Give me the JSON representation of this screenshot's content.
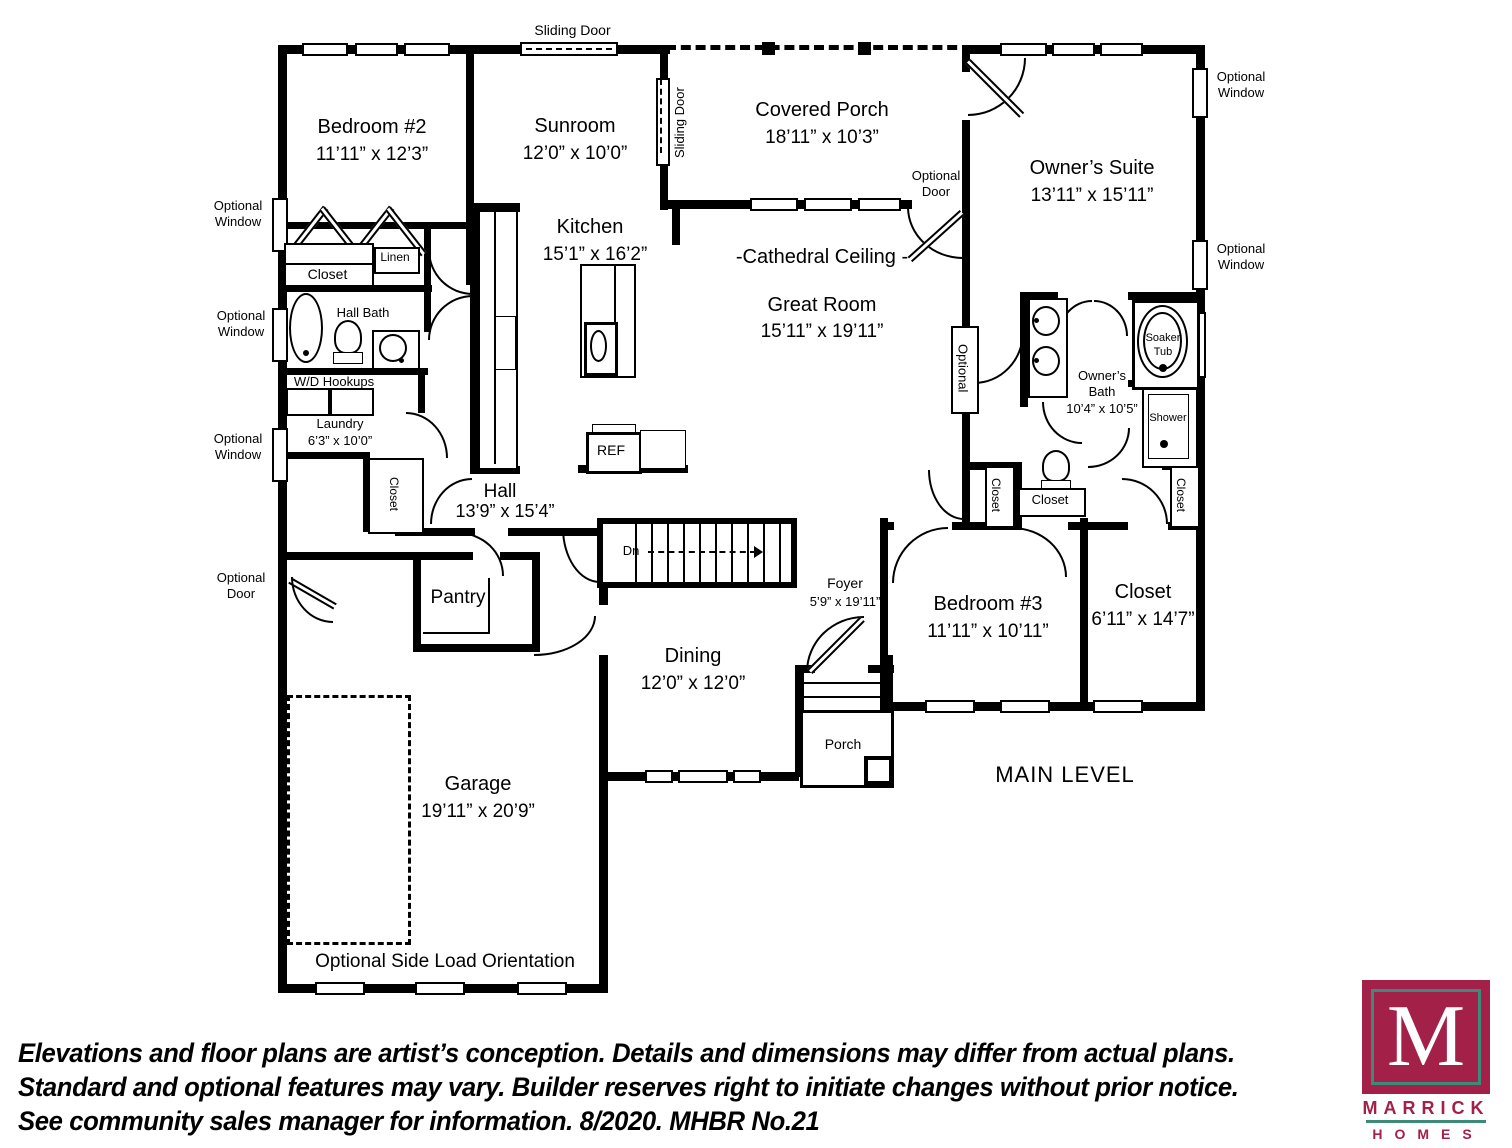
{
  "plan": {
    "level_title": "MAIN LEVEL",
    "rooms": {
      "bedroom2": {
        "name": "Bedroom #2",
        "dims": "11’11” x 12’3”"
      },
      "sunroom": {
        "name": "Sunroom",
        "dims": "12’0” x 10’0”"
      },
      "covered_porch": {
        "name": "Covered Porch",
        "dims": "18’11” x 10’3”"
      },
      "owners_suite": {
        "name": "Owner’s Suite",
        "dims": "13’11” x 15’11”"
      },
      "kitchen": {
        "name": "Kitchen",
        "dims": "15’1” x 16’2”"
      },
      "great_room": {
        "name": "Great Room",
        "dims": "15’11” x 19’11”",
        "note": "-Cathedral Ceiling -"
      },
      "laundry": {
        "name": "Laundry",
        "dims": "6’3” x 10’0”"
      },
      "hall": {
        "name": "Hall",
        "dims": "13’9” x 15’4”"
      },
      "owners_bath": {
        "name": "Owner’s\nBath\n10’4” x 10’5”"
      },
      "foyer": {
        "name": "Foyer",
        "dims": "5’9” x 19’11”"
      },
      "dining": {
        "name": "Dining",
        "dims": "12’0” x 12’0”"
      },
      "bedroom3": {
        "name": "Bedroom #3",
        "dims": "11’11” x 10’11”"
      },
      "closet_big": {
        "name": "Closet",
        "dims": "6’11” x 14’7”"
      },
      "garage": {
        "name": "Garage",
        "dims": "19’11” x 20’9”"
      },
      "porch": {
        "name": "Porch"
      },
      "pantry": {
        "name": "Pantry"
      }
    },
    "labels": {
      "sliding_door": "Sliding Door",
      "optional_window": "Optional\nWindow",
      "optional_door": "Optional\nDoor",
      "optional": "Optional",
      "closet": "Closet",
      "linen": "Linen",
      "hall_bath": "Hall Bath",
      "wd_hookups": "W/D Hookups",
      "soaker_tub": "Soaker\nTub",
      "shower": "Shower",
      "ref": "REF",
      "dn": "Dn",
      "side_load": "Optional Side Load Orientation"
    }
  },
  "disclaimer": {
    "line1": "Elevations and floor plans are artist’s conception. Details and dimensions may differ from actual plans.",
    "line2": "Standard and optional features may vary. Builder reserves right to initiate changes without prior notice.",
    "line3": "See community sales manager for information. 8/2020. MHBR No.21"
  },
  "logo": {
    "monogram": "M",
    "brand": "MARRICK",
    "sub": "HOMES",
    "brand_color": "#a32049",
    "accent_color": "#3d8a78"
  }
}
